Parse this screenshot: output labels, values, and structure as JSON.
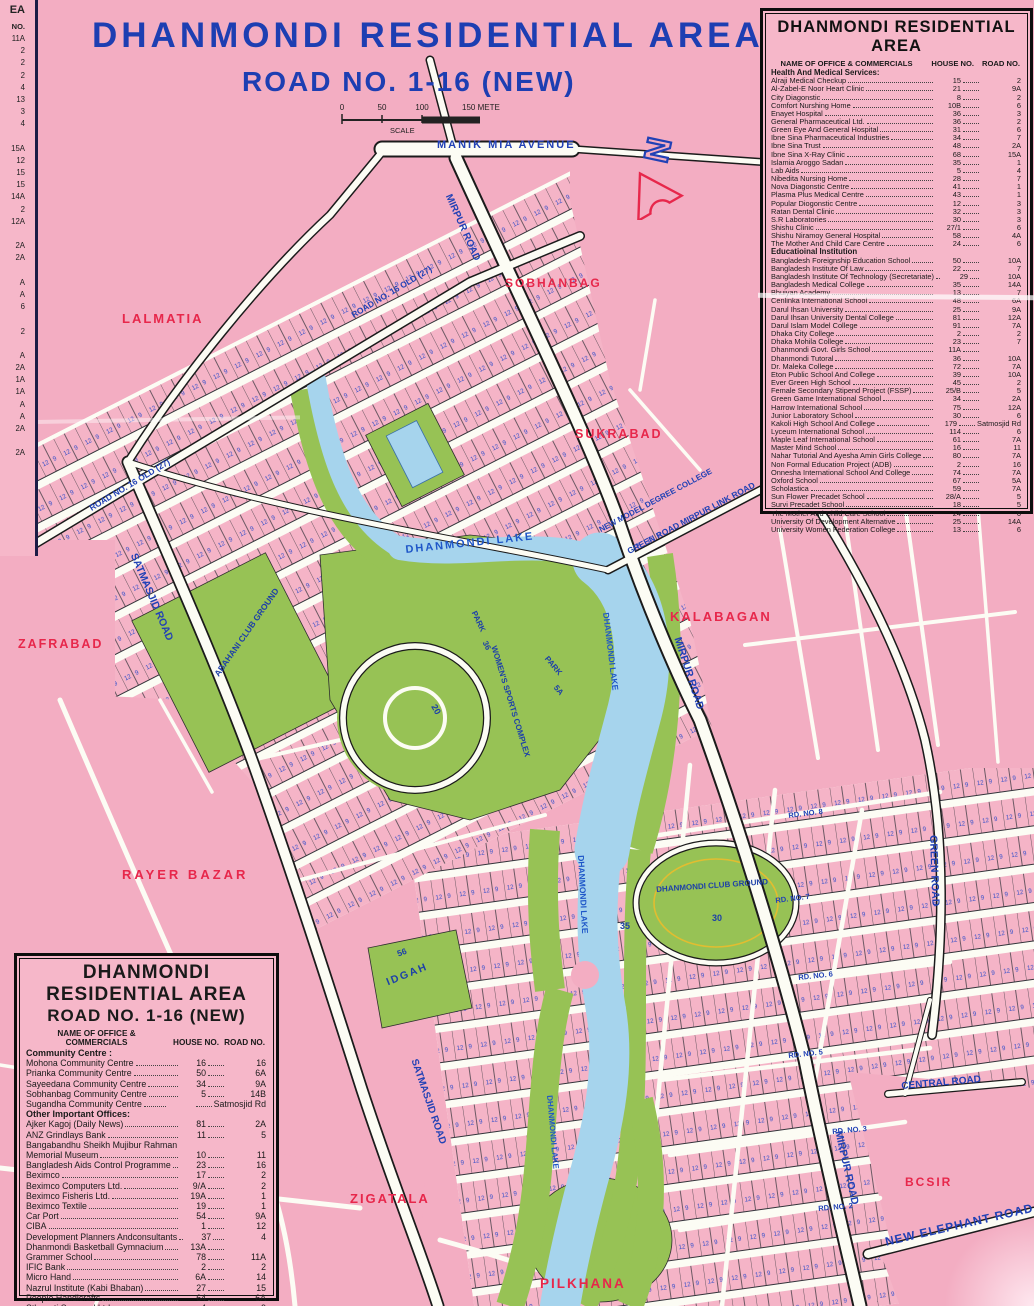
{
  "title": {
    "line1": "DHANMONDI RESIDENTIAL AREA",
    "line2": "ROAD NO. 1-16 (NEW)"
  },
  "scale": {
    "t0": "0",
    "t1": "50",
    "t2": "100",
    "t3": "150 METER",
    "label": "SCALE"
  },
  "north": {
    "letter": "N"
  },
  "colors": {
    "map_pink": "#f3adc2",
    "panel_pink": "#f6b7c9",
    "road_white": "#fcfcf4",
    "park_green": "#97c255",
    "lake_blue": "#a6d4ed",
    "label_red": "#e7274b",
    "label_blue": "#2141b5",
    "title_blue": "#1d3eb2"
  },
  "left_strip": {
    "header": "EA",
    "col": "NO.",
    "values": [
      "11A",
      "2",
      "2",
      "2",
      "4",
      "13",
      "3",
      "4",
      "",
      "15A",
      "12",
      "15",
      "15",
      "14A",
      "2",
      "12A",
      "",
      "2A",
      "2A",
      "",
      "A",
      "A",
      "6",
      "",
      "2",
      "",
      "A",
      "2A",
      "1A",
      "1A",
      "A",
      "A",
      "2A",
      "",
      "2A"
    ]
  },
  "directory_right": {
    "title": "DHANMONDI RESIDENTIAL AREA",
    "columns": {
      "name": "NAME OF OFFICE & COMMERCIALS",
      "house": "HOUSE NO.",
      "road": "ROAD NO."
    },
    "sections": [
      {
        "heading": "Health And Medical Services:",
        "rows": [
          {
            "name": "Alraji Medical Checkup",
            "house": "15",
            "road": "2"
          },
          {
            "name": "Al-Zabel-E Noor Heart Clinic",
            "house": "21",
            "road": "9A"
          },
          {
            "name": "City Diagonstic",
            "house": "8",
            "road": "2"
          },
          {
            "name": "Comfort Nurshing Home",
            "house": "10B",
            "road": "6"
          },
          {
            "name": "Enayet Hospital",
            "house": "36",
            "road": "3"
          },
          {
            "name": "General Pharmaceutical Ltd.",
            "house": "36",
            "road": "2"
          },
          {
            "name": "Green Eye And General Hospital",
            "house": "31",
            "road": "6"
          },
          {
            "name": "Ibne Sina Pharmaceutical Industries",
            "house": "34",
            "road": "7"
          },
          {
            "name": "Ibne Sina Trust",
            "house": "48",
            "road": "2A"
          },
          {
            "name": "Ibne Sina X-Ray Clinic",
            "house": "68",
            "road": "15A"
          },
          {
            "name": "Islamia Aroggo Sadan",
            "house": "35",
            "road": "1"
          },
          {
            "name": "Lab Aids",
            "house": "5",
            "road": "4"
          },
          {
            "name": "Nibedita Nursing Home",
            "house": "28",
            "road": "7"
          },
          {
            "name": "Nova Diagonstic Centre",
            "house": "41",
            "road": "1"
          },
          {
            "name": "Plasma Plus Medical Centre",
            "house": "43",
            "road": "1"
          },
          {
            "name": "Popular Diogonstic Centre",
            "house": "12",
            "road": "3"
          },
          {
            "name": "Ratan Dental Clinic",
            "house": "32",
            "road": "3"
          },
          {
            "name": "S.R Laboratories",
            "house": "30",
            "road": "3"
          },
          {
            "name": "Shishu Clinic",
            "house": "27/1",
            "road": "6"
          },
          {
            "name": "Shishu Niramoy General Hospital",
            "house": "58",
            "road": "4A"
          },
          {
            "name": "The Mother And Child Care Centre",
            "house": "24",
            "road": "6"
          }
        ]
      },
      {
        "heading": "Educatioinal Institution",
        "rows": [
          {
            "name": "Bangladesh Foreignship Education School",
            "house": "50",
            "road": "10A"
          },
          {
            "name": "Bangladesh Institute Of Law",
            "house": "22",
            "road": "7"
          },
          {
            "name": "Bangladesh Institute Of Technology (Secretariate)",
            "house": "29",
            "road": "10A"
          },
          {
            "name": "Bangladesh Medical College",
            "house": "35",
            "road": "14A"
          },
          {
            "name": "Bhuiyan Academy",
            "house": "13",
            "road": "7"
          },
          {
            "name": "Cenlinka International School",
            "house": "48",
            "road": "6A"
          },
          {
            "name": "Darul Ihsan University",
            "house": "25",
            "road": "9A"
          },
          {
            "name": "Darul Ihsan University Dental College",
            "house": "81",
            "road": "12A"
          },
          {
            "name": "Darul Islam Model College",
            "house": "91",
            "road": "7A"
          },
          {
            "name": "Dhaka City College",
            "house": "2",
            "road": "2"
          },
          {
            "name": "Dhaka Mohila College",
            "house": "23",
            "road": "7"
          },
          {
            "name": "Dhanmondi Govt. Girls School",
            "house": "11A",
            "road": ""
          },
          {
            "name": "Dhanmondi Tutoral",
            "house": "36",
            "road": "10A"
          },
          {
            "name": "Dr. Maleka College",
            "house": "72",
            "road": "7A"
          },
          {
            "name": "Eton Public School And College",
            "house": "39",
            "road": "10A"
          },
          {
            "name": "Ever Green High School",
            "house": "45",
            "road": "2"
          },
          {
            "name": "Female Secondary Stipend Project (FSSP)",
            "house": "25/B",
            "road": "5"
          },
          {
            "name": "Green Game International School",
            "house": "34",
            "road": "2A"
          },
          {
            "name": "Harrow International School",
            "house": "75",
            "road": "12A"
          },
          {
            "name": "Junior Laboratory School",
            "house": "30",
            "road": "6"
          },
          {
            "name": "Kakoli High School And College",
            "house": "179",
            "road": "Satmosjid Rd"
          },
          {
            "name": "Lyceum International School",
            "house": "114",
            "road": "6"
          },
          {
            "name": "Maple Leaf International School",
            "house": "61",
            "road": "7A"
          },
          {
            "name": "Master Mind School",
            "house": "16",
            "road": "11"
          },
          {
            "name": "Nahar Tutorial And Ayesha Amin Girls College",
            "house": "80",
            "road": "7A"
          },
          {
            "name": "Non Formal Education Project (ADB)",
            "house": "2",
            "road": "16"
          },
          {
            "name": "Onnesha International School And College",
            "house": "74",
            "road": "7A"
          },
          {
            "name": "Oxford School",
            "house": "67",
            "road": "5A"
          },
          {
            "name": "Scholastica",
            "house": "59",
            "road": "7A"
          },
          {
            "name": "Sun Flower Precadet School",
            "house": "28/A",
            "road": "5"
          },
          {
            "name": "Survi Precadet School",
            "house": "18",
            "road": "5"
          },
          {
            "name": "The Mother And Child Care School",
            "house": "24",
            "road": "6"
          },
          {
            "name": "University Of Development Alternative",
            "house": "25",
            "road": "14A"
          },
          {
            "name": "University Women Federation College",
            "house": "13",
            "road": "6"
          }
        ]
      }
    ]
  },
  "directory_left": {
    "title_line1": "DHANMONDI RESIDENTIAL AREA",
    "title_line2": "ROAD NO. 1-16 (NEW)",
    "columns": {
      "name": "NAME OF OFFICE & COMMERCIALS",
      "house": "HOUSE NO.",
      "road": "ROAD NO."
    },
    "sections": [
      {
        "heading": "Community Centre :",
        "rows": [
          {
            "name": "Mohona Community Centre",
            "house": "16",
            "road": "16"
          },
          {
            "name": "Prianka Community Centre",
            "house": "50",
            "road": "6A"
          },
          {
            "name": "Sayeedana Community Centre",
            "house": "34",
            "road": "9A"
          },
          {
            "name": "Sobhanbag Community Centre",
            "house": "5",
            "road": "14B"
          },
          {
            "name": "Sugandha Community Centre",
            "house": "",
            "road": "Satmosjid Rd"
          }
        ]
      },
      {
        "heading": "Other Important Offices:",
        "rows": [
          {
            "name": "Ajker Kagoj (Daily News)",
            "house": "81",
            "road": "2A"
          },
          {
            "name": "ANZ Grindlays Bank",
            "house": "11",
            "road": "5"
          },
          {
            "name": "Bangabandhu Sheikh Mujibur Rahman",
            "house": "",
            "road": "",
            "wrap": true
          },
          {
            "name": "Memorial Museum",
            "house": "10",
            "road": "11"
          },
          {
            "name": "Bangladesh Aids Control Programme",
            "house": "23",
            "road": "16"
          },
          {
            "name": "Beximco",
            "house": "17",
            "road": "2"
          },
          {
            "name": "Beximco Computers Ltd.",
            "house": "9/A",
            "road": "2"
          },
          {
            "name": "Beximco Fisheris Ltd.",
            "house": "19A",
            "road": "1"
          },
          {
            "name": "Beximco Textile",
            "house": "19",
            "road": "1"
          },
          {
            "name": "Car Port",
            "house": "54",
            "road": "9A"
          },
          {
            "name": "CIBA",
            "house": "1",
            "road": "12"
          },
          {
            "name": "Development Planners Andconsultants",
            "house": "37",
            "road": "4"
          },
          {
            "name": "Dhanmondi Basketball Gymnacium",
            "house": "13A",
            "road": ""
          },
          {
            "name": "Grammer School",
            "house": "78",
            "road": "11A"
          },
          {
            "name": "IFIC Bank",
            "house": "2",
            "road": "2"
          },
          {
            "name": "Micro Hand",
            "house": "6A",
            "road": "14"
          },
          {
            "name": "Nazrul Institute (Kabi Bhaban)",
            "house": "27",
            "road": "15"
          },
          {
            "name": "People Handicrafts",
            "house": "64",
            "road": "6A"
          },
          {
            "name": "Sthapati Sangsad Ltd.",
            "house": "4",
            "road": "9"
          },
          {
            "name": "Sudan Bangladesh Friendship Association",
            "house": "53",
            "road": "3A"
          },
          {
            "name": "The Daily Star",
            "house": "11",
            "road": "3"
          }
        ]
      }
    ]
  },
  "map": {
    "labels": {
      "lalmatia": "LALMATIA",
      "sobhanbag": "SOBHANBAG",
      "sukrabad": "SUKRABAD",
      "zafrabad": "ZAFRABAD",
      "kalabagan": "KALABAGAN",
      "rayer_bazar": "RAYER BAZAR",
      "zigatala": "ZIGATALA",
      "pilkhana": "PILKHANA",
      "bcsir": "BCSIR",
      "manik_mia_avenue": "MANIK MIA AVENUE",
      "mirpur_road": "MIRPUR ROAD",
      "satmasjid_road": "SATMASJID ROAD",
      "green_road": "GREEN ROAD",
      "green_road_link": "GREEN ROAD MIRPUR LINK ROAD",
      "new_model_degree_college": "NEW MODEL DEGREE COLLEGE",
      "new_elephant_road": "NEW ELEPHANT ROAD",
      "central_road": "CENTRAL ROAD",
      "road_16_old": "ROAD NO. 16 OLD (27)",
      "rd_no_8": "RD. NO. 8",
      "rd_no_7": "RD. NO. 7",
      "rd_no_6": "RD. NO. 6",
      "rd_no_5": "RD. NO. 5",
      "rd_no_3": "RD. NO. 3",
      "rd_no_2": "RD. NO. 2",
      "dhanmondi_lake": "DHANMONDI LAKE",
      "abahani_club_ground": "ABAHANI CLUB GROUND",
      "womens_sports_complex": "WOMEN'S SPORTS COMPLEX",
      "dhanmondi_club_ground": "DHANMONDI CLUB GROUND",
      "idgah": "IDGAH",
      "park": "PARK",
      "num_30": "30",
      "num_56": "56",
      "num_20": "20",
      "num_35": "35",
      "num_36": "36",
      "num_5a": "5A"
    }
  }
}
